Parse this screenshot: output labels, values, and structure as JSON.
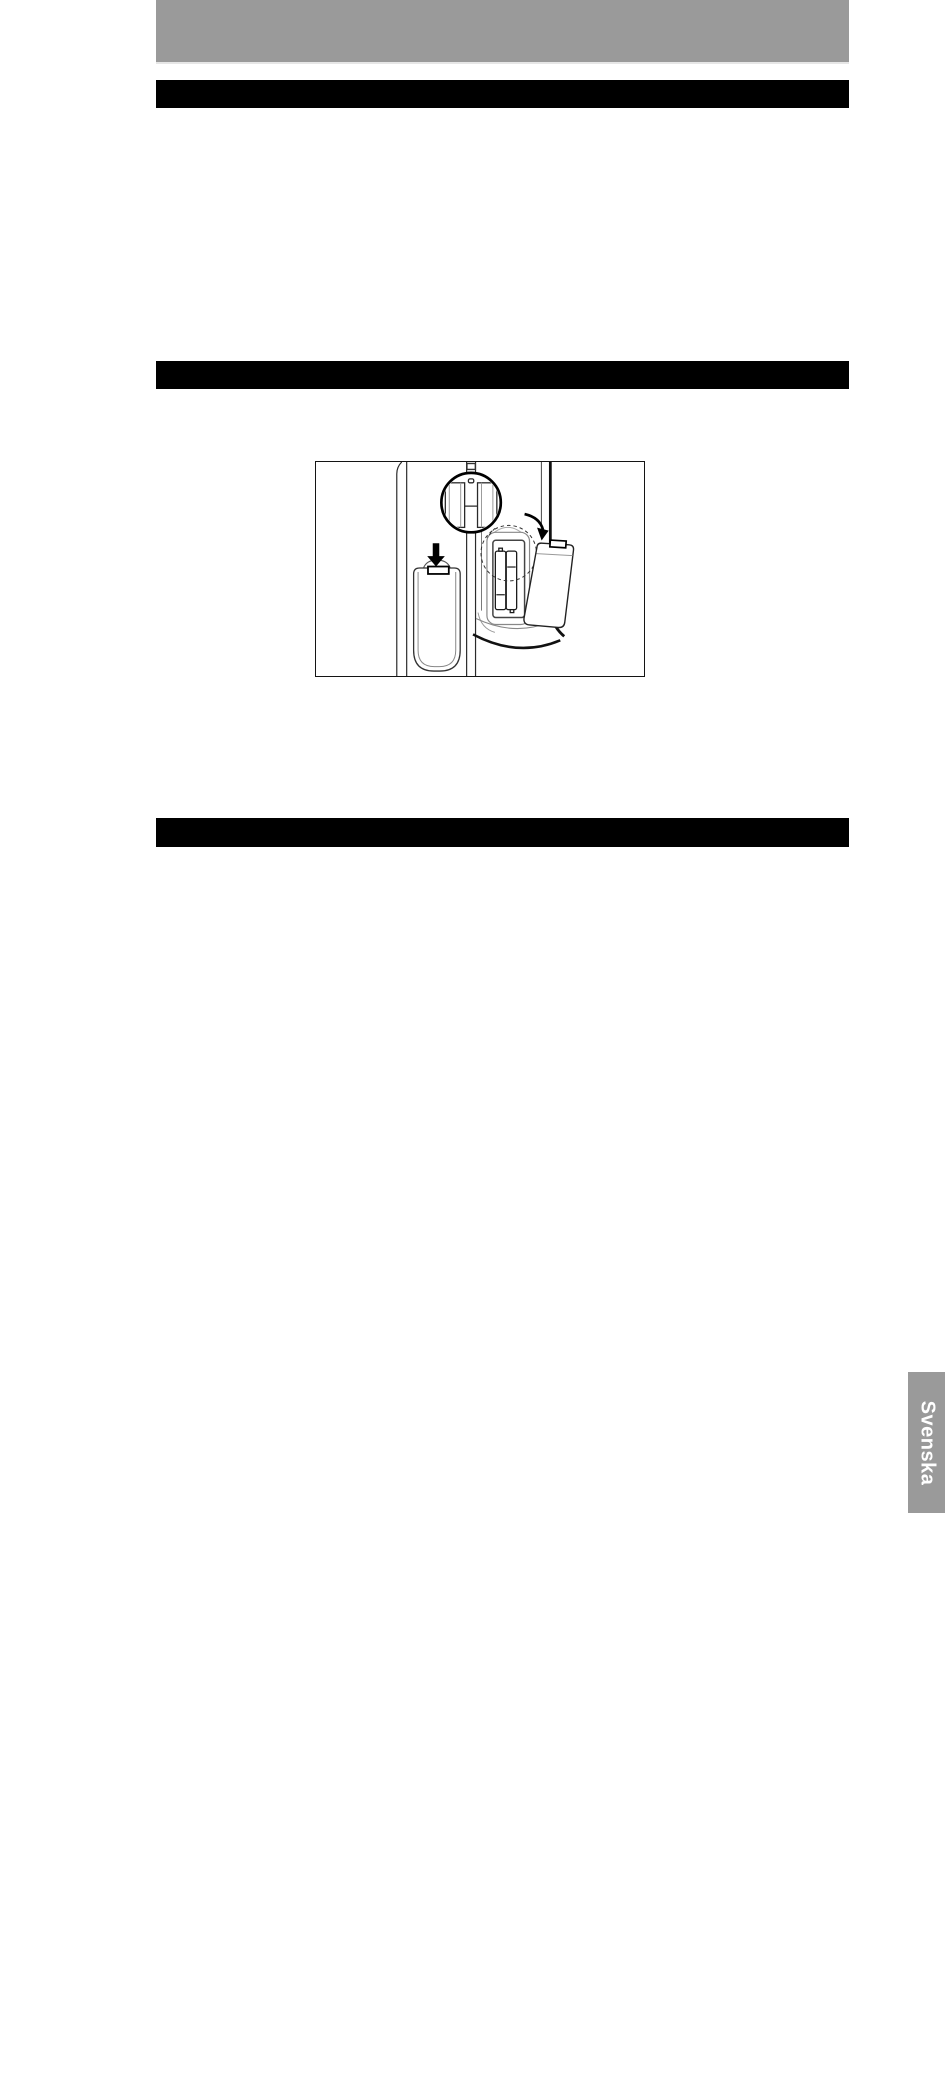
{
  "document": {
    "type": "manual-page-scan",
    "colors": {
      "page_background": "#ffffff",
      "header_band": "#9a9a9a",
      "section_bar": "#000000",
      "figure_border": "#141414"
    },
    "figure": {
      "name": "remote-control-battery-installation-diagram"
    },
    "language_tab": {
      "label": "Svenska",
      "background_color": "#9a9a9a",
      "text_color": "#ffffff"
    }
  }
}
